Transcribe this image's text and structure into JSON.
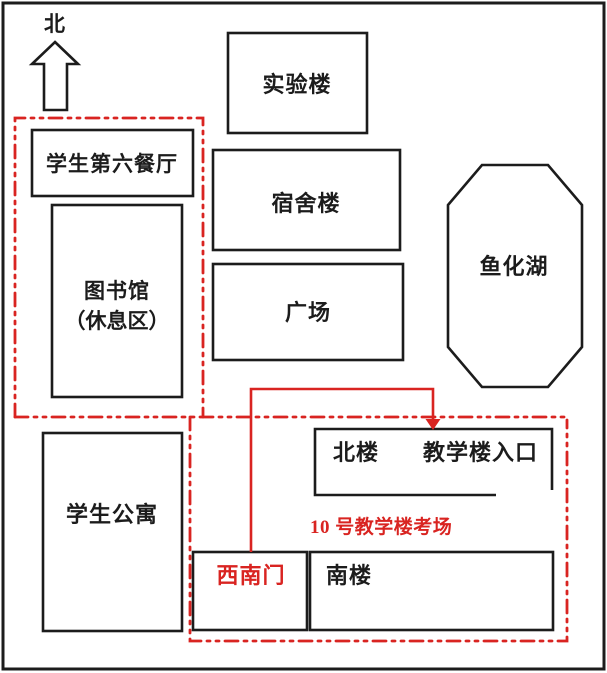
{
  "compass": {
    "label": "北"
  },
  "places": {
    "lab": "实验楼",
    "canteen": "学生第六餐厅",
    "dorm": "宿舍楼",
    "library_line1": "图书馆",
    "library_line2": "（休息区）",
    "plaza": "广场",
    "lake": "鱼化湖",
    "apartments": "学生公寓",
    "north_building": "北楼",
    "entrance": "教学楼入口",
    "south_building": "南楼",
    "gate": "西南门"
  },
  "annotations": {
    "exam_site": "10 号教学楼考场"
  },
  "colors": {
    "route_red": "#d92421",
    "outline_black": "#1c1c1c",
    "background": "#ffffff"
  }
}
